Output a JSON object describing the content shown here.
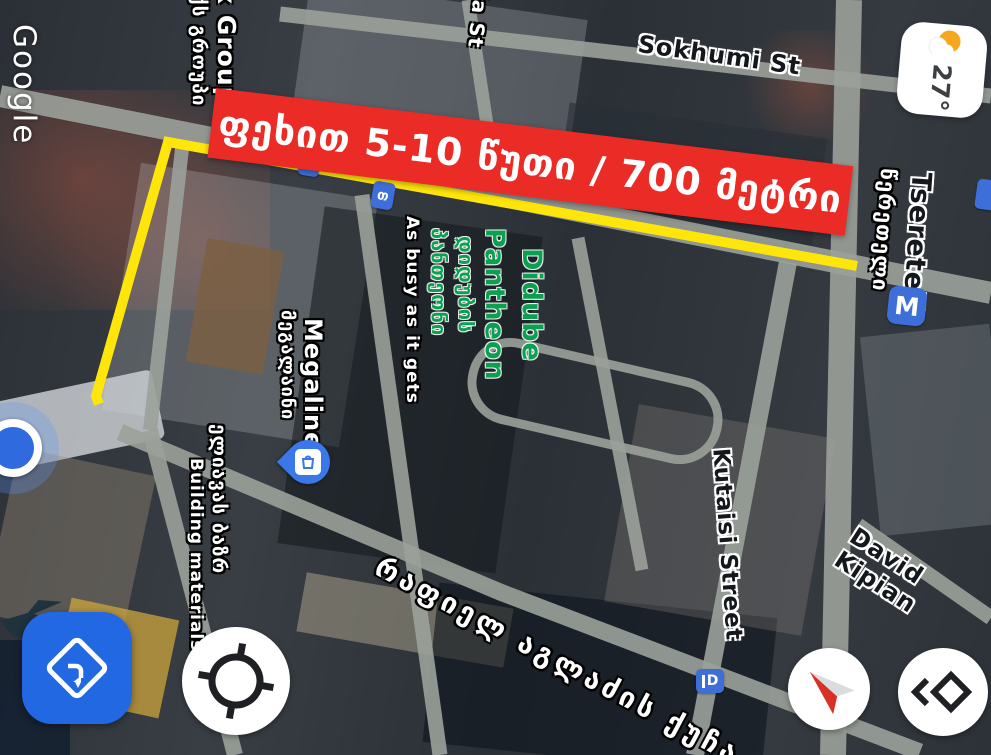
{
  "map": {
    "watermark": "Google",
    "annotation": {
      "banner_text": "ფეხით 5-10 წუთი / 700 მეტრი",
      "banner_color": "#ea2b26",
      "route_color": "#ffe60a"
    },
    "street_labels": {
      "sokhumi": "Sokhumi St",
      "ia_st": "ia St",
      "tsereteli_en": "Tsereteli",
      "tsereteli_ka": "წერეთელი",
      "kutaisi": "Kutaisi Street",
      "kipiani": "David Kipian",
      "agladze_ka": "რაფიელ აგლაძის ქუჩა"
    },
    "poi_labels": {
      "partner_group_en": "x Group",
      "partner_group_ka": "ქს გროუპი",
      "didube_en_line1": "Didube",
      "didube_en_line2": "Pantheon",
      "didube_ka_line1": "დიდუბის",
      "didube_ka_line2": "პანთეონი",
      "busy_note": "As busy as it gets",
      "megaline_en": "Megaline",
      "megaline_ka": "მეგალაინი",
      "eliava_ka": "ელიავას ბაზრ",
      "building_materials": "Building materials"
    },
    "badges": {
      "metro_m": "M",
      "transit_a": "თ",
      "transit_b": "თ",
      "road_shield": "D",
      "pin_color": "#3a77e8",
      "badge_color": "#3e6fd8"
    }
  },
  "weather": {
    "temperature": "27°",
    "condition": "partly-cloudy"
  },
  "controls": {
    "directions_fab_color": "#2368e3"
  }
}
